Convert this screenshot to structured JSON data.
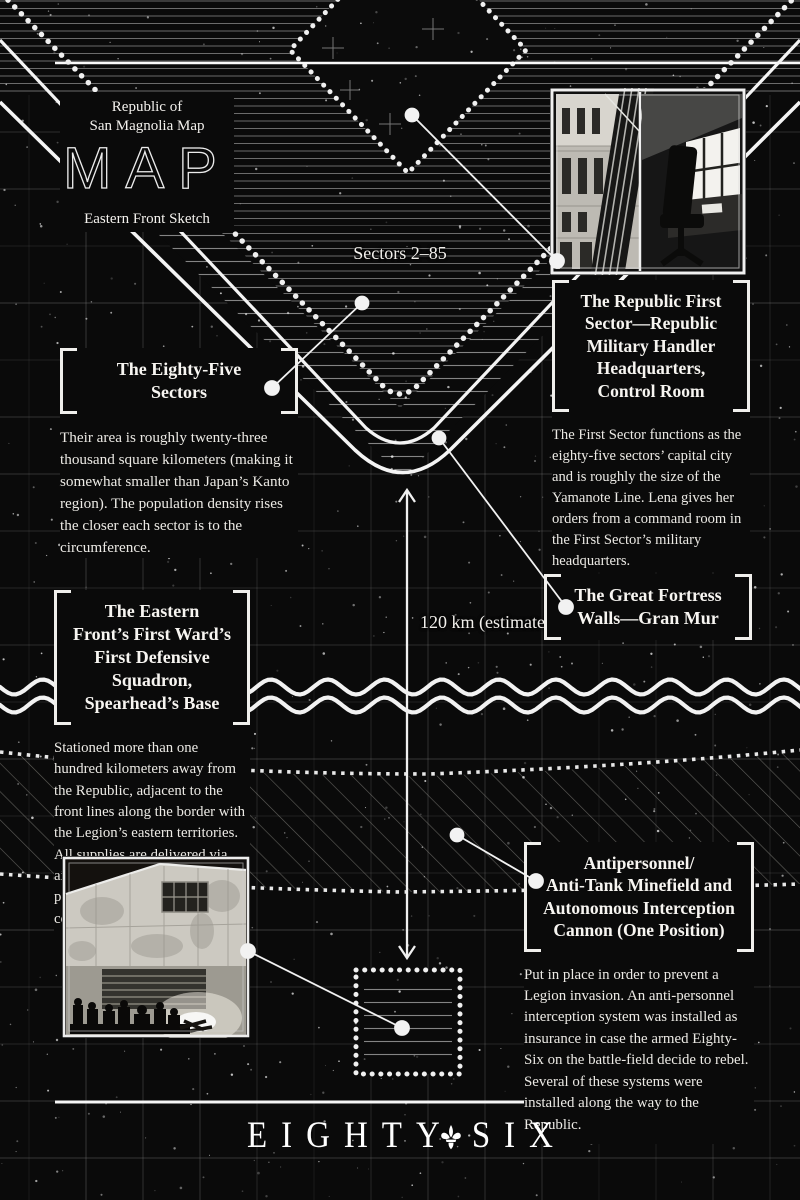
{
  "header": {
    "kicker_line1": "Republic of",
    "kicker_line2": "San Magnolia Map",
    "big_title": "MAP",
    "subtitle": "Eastern Front Sketch"
  },
  "map_labels": {
    "sectors": "Sectors 2–85",
    "distance": "120 km (estimate)"
  },
  "callouts": {
    "first_sector": {
      "title": "The Republic First\nSector—Republic\nMilitary Handler\nHeadquarters,\nControl Room",
      "body": "The First Sector functions as the eighty-five sectors’ capital city and is roughly the size of the Yamanote Line. Lena gives her orders from a command room in the First Sector’s military headquarters."
    },
    "eighty_five": {
      "title": "The Eighty-Five\nSectors",
      "body": "Their area is roughly twenty-three thousand square kilometers (making it somewhat smaller than Japan’s Kanto region). The population density rises the closer each sector is to the circumference."
    },
    "gran_mur": {
      "title": "The Great Fortress\nWalls—Gran Mur"
    },
    "spearhead": {
      "title": "The Eastern\nFront’s First Ward’s\nFirst Defensive\nSquadron,\nSpearhead’s Base",
      "body": "Stationed more than one hundred kilometers away from the Republic, adjacent to the front lines along the border with the Legion’s eastern territories. All supplies are delivered via airplane, and unauthorized personnel are not allowed to come or go from the base."
    },
    "minefield": {
      "title": "Antipersonnel/\nAnti-Tank Minefield and\nAutonomous Interception\nCannon (One Position)",
      "body": "Put in place in order to prevent a Legion invasion. An anti-personnel interception system was installed as insurance in case the armed Eighty-Six on the battle-field decide to rebel. Several of these systems were installed along the way to the Republic."
    }
  },
  "images": {
    "first_sector_photo": "First Sector headquarters exterior and control room",
    "spearhead_photo": "Spearhead base hangar with soldiers around a campfire"
  },
  "logo": {
    "word1": "EIGHTY",
    "word2": "SIX",
    "separator_icon": "fleur-de-lis"
  },
  "colors": {
    "background": "#0a0a0a",
    "ink": "#f2f0ec",
    "line": "#ededed",
    "grid": "#8f8f8f"
  }
}
